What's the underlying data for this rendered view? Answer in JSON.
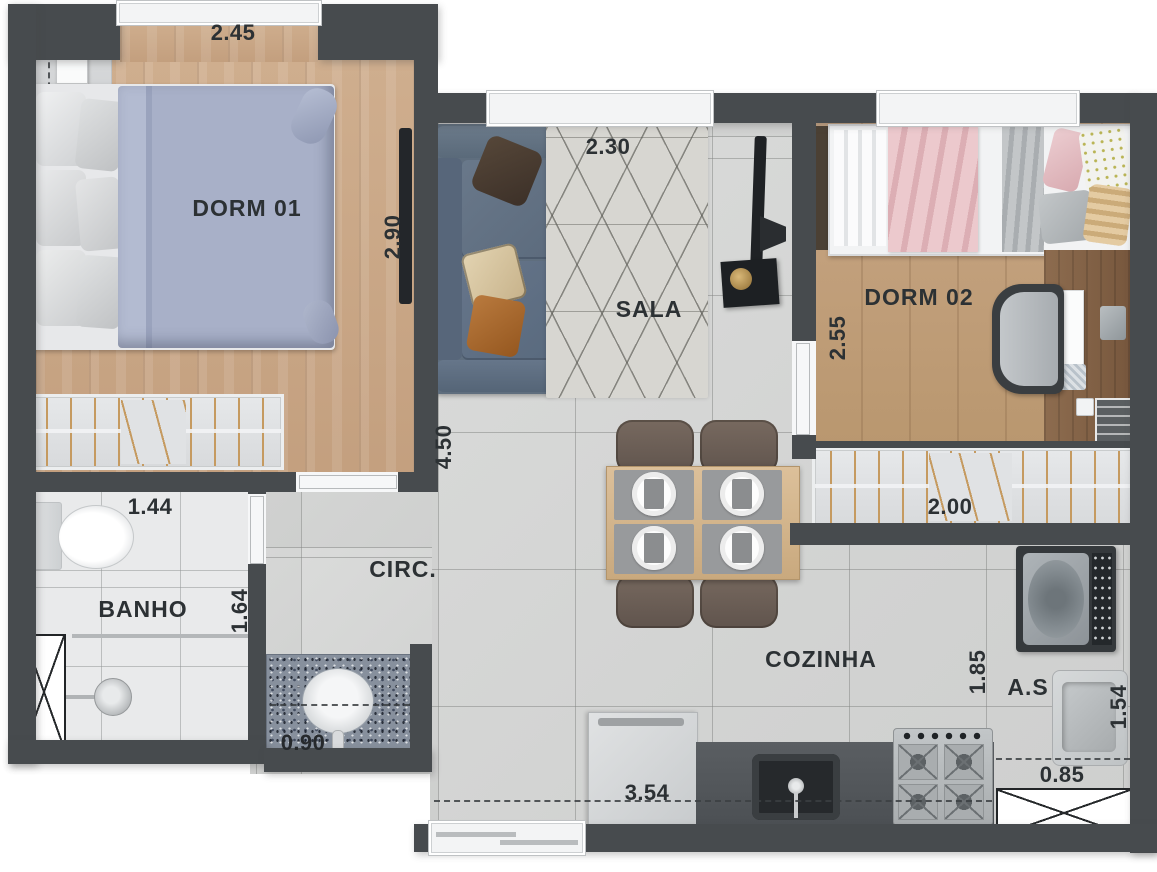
{
  "plan_title": "2-bedroom apartment floor plan",
  "rooms": {
    "dorm01": {
      "name": "DORM 01",
      "width_label": "2.45",
      "depth_label": "2.90"
    },
    "sala": {
      "name": "SALA",
      "width_label": "2.30",
      "length_label": "4.50"
    },
    "dorm02": {
      "name": "DORM 02",
      "depth_label": "2.55",
      "closet_label": "2.00"
    },
    "banho": {
      "name": "BANHO",
      "width_label": "1.44",
      "depth_label": "1.64"
    },
    "circ": {
      "name": "CIRC.",
      "counter_label": "0.90"
    },
    "cozinha": {
      "name": "COZINHA",
      "width_label": "3.54",
      "depth_label": "1.85"
    },
    "area_servico": {
      "name": "A.S",
      "depth_label": "1.54",
      "width_label": "0.85"
    }
  },
  "colors": {
    "wall": "#474b4e",
    "wood_floor": "#c9a888",
    "tile_floor": "#d5d6d5",
    "bath_tile": "#e9eaeb",
    "label_text": "#2c3134",
    "sofa": "#5f6e7e",
    "duvet": "#a6aec6",
    "pink_blanket": "#e5bfc3",
    "counter": "#53575b",
    "granite": "#87909d"
  }
}
